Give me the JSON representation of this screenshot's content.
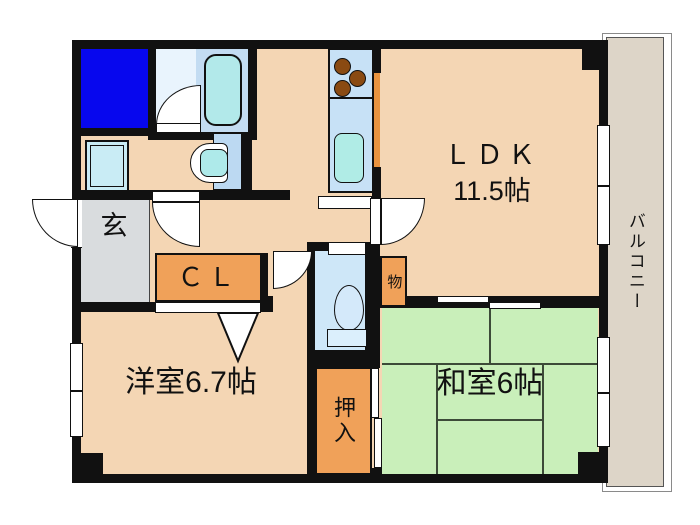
{
  "floorplan": {
    "rooms": {
      "ldk": {
        "label": "ＬＤＫ",
        "area": "11.5帖"
      },
      "balcony": {
        "label": "バルコニー"
      },
      "entrance": {
        "label": "玄"
      },
      "closet": {
        "label": "ＣＬ"
      },
      "storage": {
        "label": "物"
      },
      "western_room": {
        "label": "洋室6.7帖"
      },
      "oshiire": {
        "label": "押入"
      },
      "japanese_room": {
        "label": "和室6帖"
      }
    },
    "colors": {
      "floor_peach": "#f4d6b4",
      "tatami_green": "#c9efba",
      "closet_orange": "#f0a159",
      "counter_orange": "#e8933f",
      "entry_gray": "#d9dcde",
      "fixture_blue": "#0707ee",
      "water_area_blue": "#c7e1f6",
      "bath_light_blue": "#e9f4fd",
      "sink_cyan": "#b0ece6",
      "burner_brown": "#8a4a12",
      "balcony_beige": "#ddd5c8",
      "wall_black": "#111111"
    }
  }
}
